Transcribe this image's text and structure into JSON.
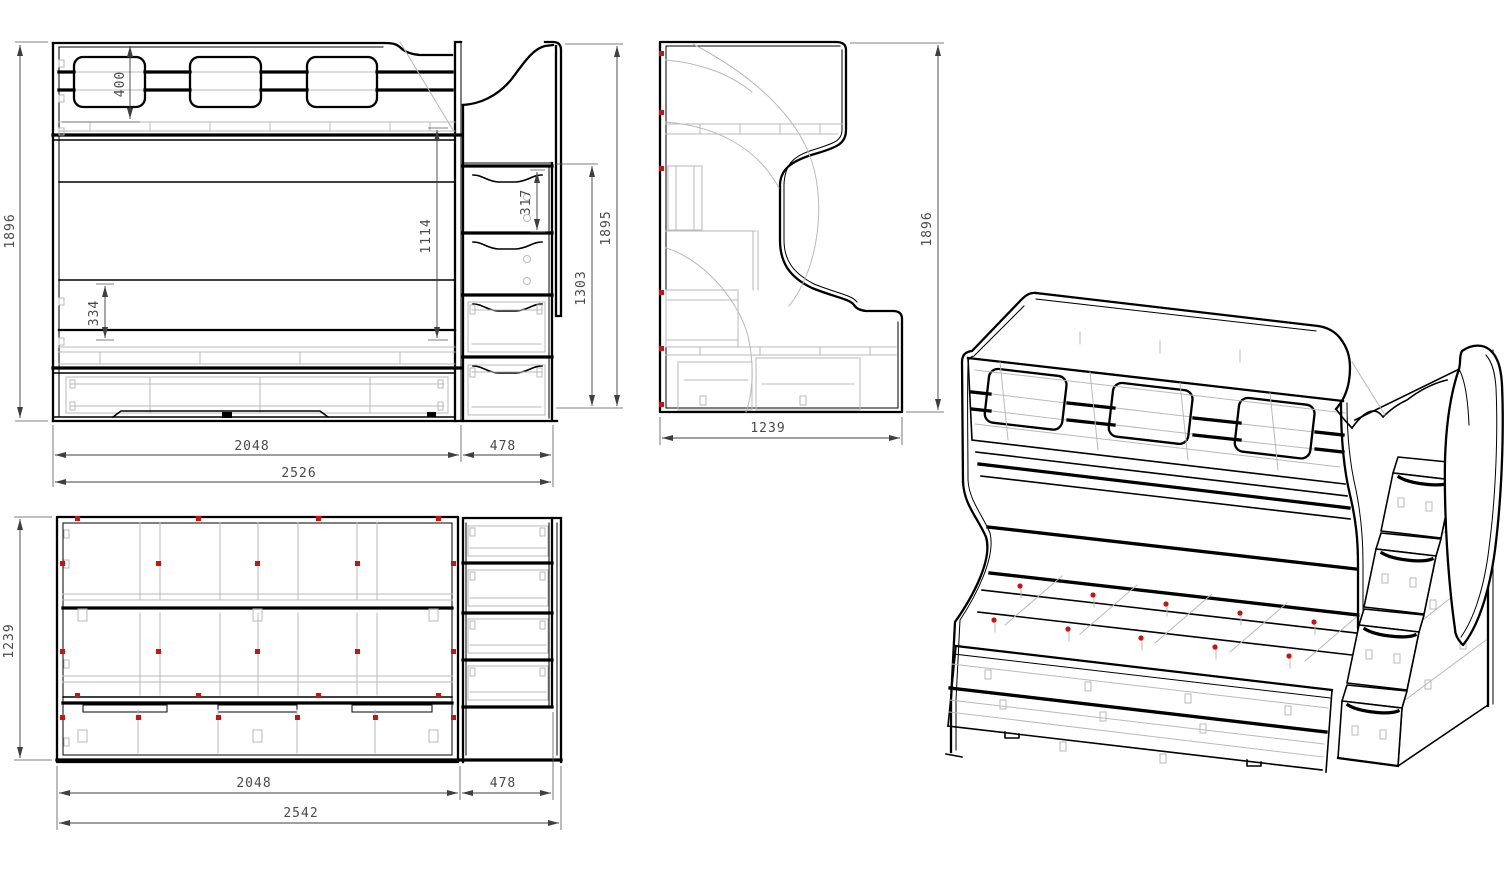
{
  "drawing": {
    "title": "bunk-bed with stair drawers — orthographic and isometric technical drawing",
    "colors": {
      "background": "#ffffff",
      "outline": "#000000",
      "hidden_lines": "#b9b9b9",
      "fastener_markers": "#cc1111",
      "dimension_text": "#4a4a4a"
    },
    "views": {
      "front_view": {
        "label": "front view",
        "dimensions": {
          "total_height": "1896",
          "guard_rail_height": "400",
          "rail_to_platform": "1114",
          "drawer_zone_height": "334",
          "step_pitch": "317",
          "stair_drawers_height": "1303",
          "stair_total_height": "1895",
          "bed_width": "2048",
          "stair_width": "478",
          "total_width": "2526"
        }
      },
      "side_view": {
        "label": "side view",
        "dimensions": {
          "depth": "1239",
          "total_height": "1896"
        }
      },
      "top_view": {
        "label": "top view",
        "dimensions": {
          "depth": "1239",
          "bed_width": "2048",
          "stair_width": "478",
          "total_width": "2542"
        }
      },
      "isometric_view": {
        "label": "isometric view"
      }
    }
  }
}
